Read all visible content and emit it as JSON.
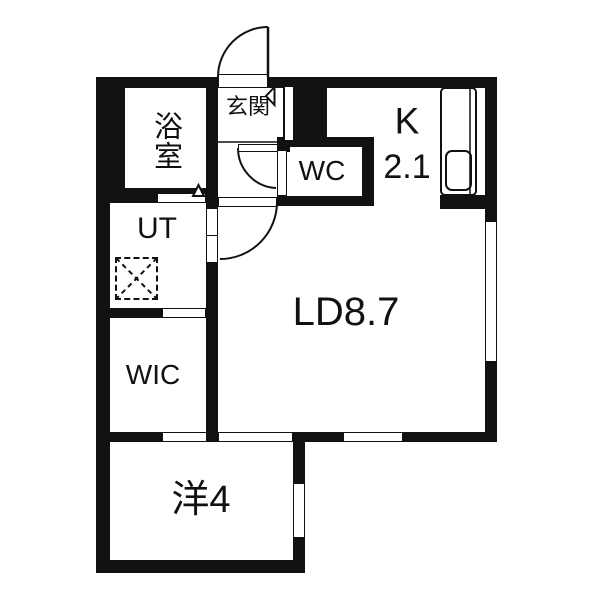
{
  "plan_title": "1LDK apartment floor plan",
  "rooms": {
    "bath": "浴室",
    "entrance": "玄関",
    "toilet": "WC",
    "kitchen": "K",
    "kitchen_size": "2.1",
    "living_dining": "LD8.7",
    "utility": "UT",
    "closet": "WIC",
    "western_room": "洋4"
  },
  "symbols": {
    "washer_space": "dashed-x-square",
    "entrance_storage_mark": "left-triangle",
    "bath_door_mark": "up-triangle",
    "doors": "quarter-arc-swing",
    "kitchen_fixture": "counter-with-sink"
  },
  "colors": {
    "wall": "#111111",
    "floor": "#ffffff"
  }
}
